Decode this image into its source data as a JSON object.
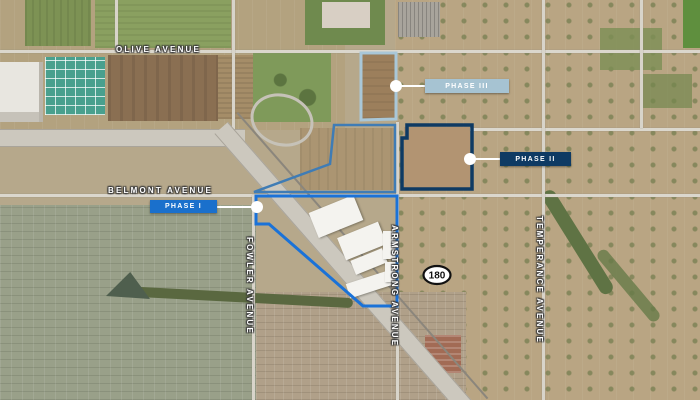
{
  "map": {
    "type": "satellite-aerial",
    "streets": {
      "olive": {
        "label": "OLIVE AVENUE",
        "orientation": "horizontal"
      },
      "belmont": {
        "label": "BELMONT AVENUE",
        "orientation": "horizontal"
      },
      "fowler": {
        "label": "FOWLER AVENUE",
        "orientation": "vertical"
      },
      "armstrong": {
        "label": "ARMSTRONG AVENUE",
        "orientation": "vertical"
      },
      "temperance": {
        "label": "TEMPERANCE AVENUE",
        "orientation": "vertical"
      }
    },
    "highway": {
      "shield_number": "180",
      "shield_shape": "oval-black-on-white"
    },
    "phases": [
      {
        "name": "phase-1",
        "label": "PHASE I",
        "box_color": "#1a70cc",
        "outline_color": "#1a72d8"
      },
      {
        "name": "phase-2",
        "label": "PHASE II",
        "box_color": "#0e3a63",
        "outline_color": "#0e3a63"
      },
      {
        "name": "phase-3",
        "label": "PHASE III",
        "box_color": "#a6c3d2",
        "outline_color": "#a9c7d8"
      }
    ],
    "extra_outline_color": "#3f7cb5",
    "callout": {
      "dot_color": "#ffffff",
      "line_color": "#ffffff"
    }
  }
}
